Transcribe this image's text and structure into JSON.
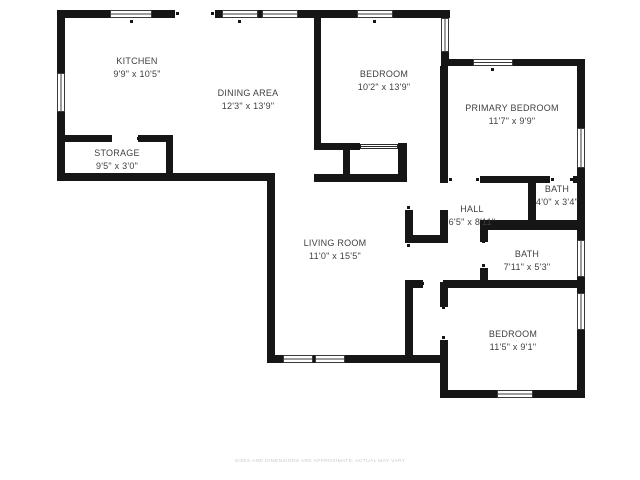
{
  "page": {
    "background_color": "#ffffff",
    "wall_color": "#161616",
    "label_color": "#3f3f3f"
  },
  "rooms": [
    {
      "id": "kitchen",
      "name": "KITCHEN",
      "dims": "9'9\" x 10'5\""
    },
    {
      "id": "dining-area",
      "name": "DINING AREA",
      "dims": "12'3\" x 13'9\""
    },
    {
      "id": "bedroom-top",
      "name": "BEDROOM",
      "dims": "10'2\" x 13'9\""
    },
    {
      "id": "primary-bedroom",
      "name": "PRIMARY BEDROOM",
      "dims": "11'7\" x 9'9\""
    },
    {
      "id": "storage",
      "name": "STORAGE",
      "dims": "9'5\" x 3'0\""
    },
    {
      "id": "hall",
      "name": "HALL",
      "dims": "6'5\" x 8'11\""
    },
    {
      "id": "bath-small",
      "name": "BATH",
      "dims": "4'0\" x 3'4\""
    },
    {
      "id": "bath",
      "name": "BATH",
      "dims": "7'11\" x 5'3\""
    },
    {
      "id": "living-room",
      "name": "LIVING ROOM",
      "dims": "11'0\" x 15'5\""
    },
    {
      "id": "bedroom-bottom",
      "name": "BEDROOM",
      "dims": "11'5\" x 9'1\""
    }
  ],
  "footer": {
    "disclaimer": "SIZES AND DIMENSIONS ARE APPROXIMATE, ACTUAL MAY VARY"
  }
}
